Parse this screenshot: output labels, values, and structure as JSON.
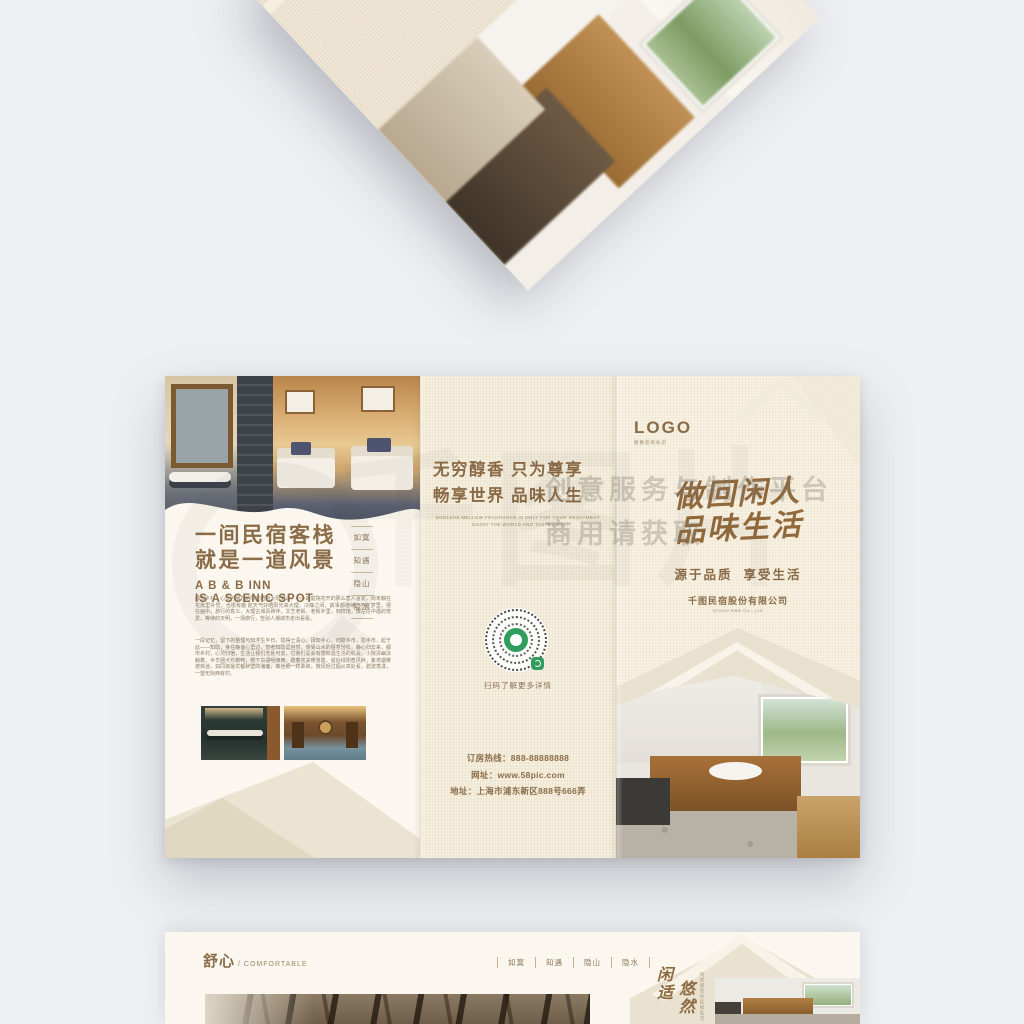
{
  "watermark": {
    "glyphs": "千图片",
    "line1": "创意服务与制作平台",
    "line2": "商用请获取"
  },
  "brochure": {
    "left_panel": {
      "title1": "一间民宿客栈",
      "title2": "就是一道风景",
      "subtitle1": "A B & B INN",
      "subtitle2": "IS A SCENIC SPOT",
      "side_labels": [
        "如寞",
        "知遇",
        "隐山",
        "隐水"
      ],
      "para1": "都市乡村，心灵可栖息的阳光晒到太阳落山，小小的庭院花开的那么惹人喜爱，周末躺在花房里补觉，也很有趣 趁天气好晒阳光来大理，冷静之间，故事都继续，不在梦里，便在画中，旅行的意义，大理古城青砖伴，文艺老街，老街乡里，到样馆，像左往中遇的宠爱，等待的天明，一场旅行，告别人潮城市走出看看。",
      "para2": "一段记忆，留下的整理与知浮生半日，隐得士清心，择知手心，归隐手市，隐手市，起于此——知隐，身在静谧心里边，智者知隐逗自然，感受山水的惬意轻松，静心归去来，都市乡村，心灵归宿，生活让我们无处可去，它我们总会有感知遇生活的机会，小院清幽凉躺着，半羊圈犬鸡鹅鸭，榕下鸟语呢喃西，踏着农夫倦落霞，屋后绿阴葱风醉，紫鸢烟雾遮目迷，如同装最优都醉壁的海面，像丝绸一样柔和，微风轻过烟从高处看，碧波荡漾，一望无际西有村。"
    },
    "middle_panel": {
      "heading1": "无穷醇香 只为尊享",
      "heading2": "畅享世界 品味人生",
      "sub1": "ENDLESS MELLOW FRAGRANCE IS ONLY FOR YOUR ENJOYMENT",
      "sub2": "ENJOY THE WORLD AND TASTE LIFE",
      "qr_caption": "扫码了解更多详情",
      "hotline": "订房热线：888-88888888",
      "website": "网址：www.58pic.com",
      "address": "地址：上海市浦东新区888号666弄"
    },
    "right_panel": {
      "logo": "LOGO",
      "logo_sub": "替换您的标识",
      "callig1": "做回闲人",
      "callig2": "品味生活",
      "tagline": "源于品质  享受生活",
      "company": "千图民宿股份有限公司",
      "company_en": "Qiantu B&B Co., Ltd"
    }
  },
  "bottom_page": {
    "title": "舒心",
    "title_en": "/ COMFORTABLE",
    "nav_labels": [
      "如寞",
      "知遇",
      "隐山",
      "隐水"
    ],
    "callig_col1": "闲适",
    "callig_col2": "悠然",
    "callig_side": "闲适悠然的民宿生活"
  },
  "colors": {
    "accent_brown": "#8a6c48",
    "calligraphy_brown": "#91693a",
    "qr_green": "#2f9e5c",
    "linen": "#f3ebd8",
    "cream": "#fbf7ee",
    "mountain": "#e9e1cf"
  }
}
